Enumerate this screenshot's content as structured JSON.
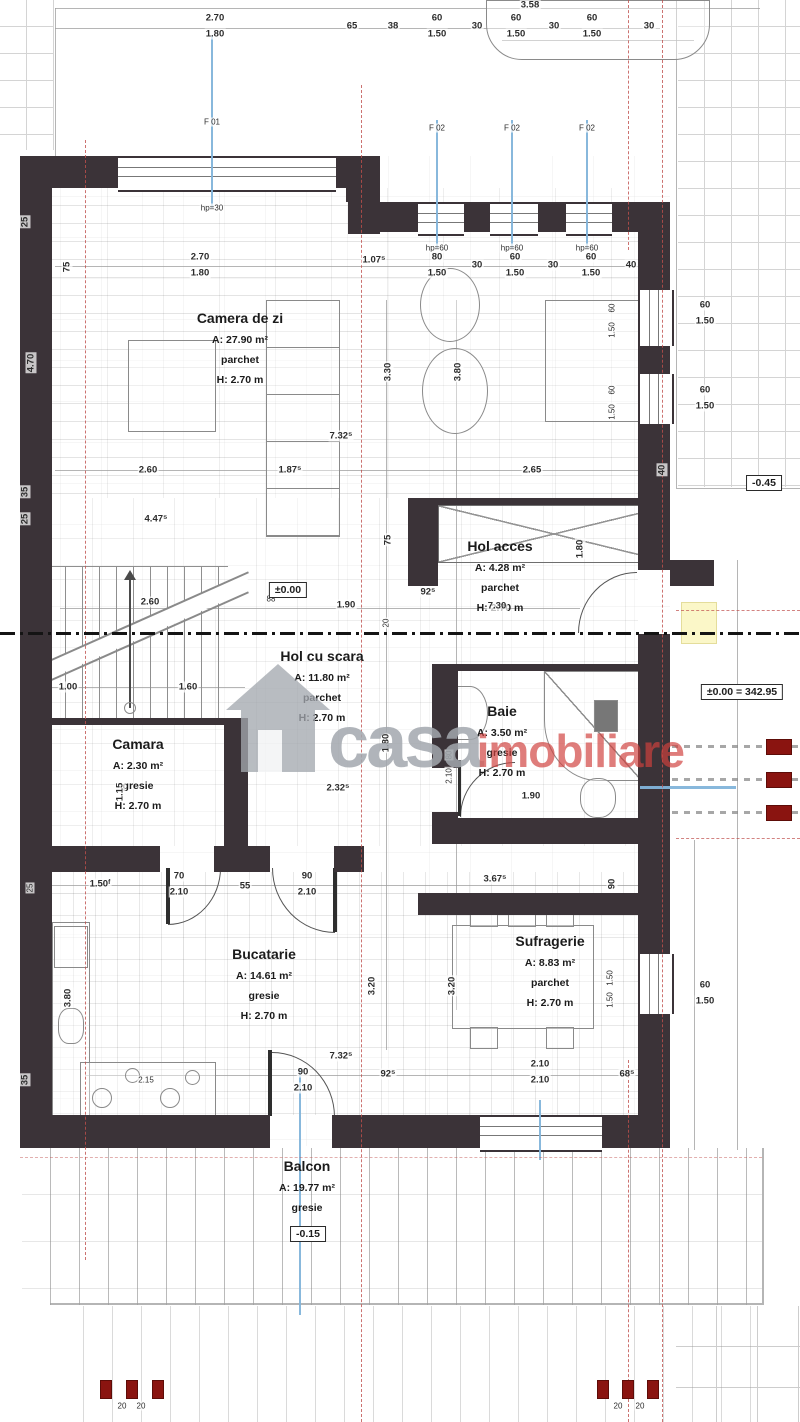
{
  "watermark": {
    "gray": "casa",
    "red": "imobiliare"
  },
  "rooms": [
    {
      "name": "Camera de zi",
      "area": "A: 27.90 m²",
      "floor": "parchet",
      "height": "H: 2.70 m"
    },
    {
      "name": "Hol acces",
      "area": "A: 4.28 m²",
      "floor": "parchet",
      "height": "H: 2.70 m"
    },
    {
      "name": "Hol cu scara",
      "area": "A: 11.80 m²",
      "floor": "parchet",
      "height": "H: 2.70 m"
    },
    {
      "name": "Camara",
      "area": "A: 2.30 m²",
      "floor": "gresie",
      "height": "H: 2.70 m"
    },
    {
      "name": "Baie",
      "area": "A: 3.50 m²",
      "floor": "gresie",
      "height": "H: 2.70 m"
    },
    {
      "name": "Bucatarie",
      "area": "A: 14.61 m²",
      "floor": "gresie",
      "height": "H: 2.70 m"
    },
    {
      "name": "Sufragerie",
      "area": "A: 8.83 m²",
      "floor": "parchet",
      "height": "H: 2.70 m"
    },
    {
      "name": "Balcon",
      "area": "A: 19.77 m²",
      "floor": "gresie"
    }
  ],
  "levels": [
    {
      "text": "±0.00",
      "x": 288,
      "y": 590
    },
    {
      "text": "-0.45",
      "x": 764,
      "y": 483
    },
    {
      "text": "±0.00 = 342.95",
      "x": 742,
      "y": 692
    },
    {
      "text": "-0.15",
      "x": 308,
      "y": 1234
    }
  ],
  "dims": [
    {
      "t": "2.70",
      "x": 215,
      "y": 18
    },
    {
      "t": "1.80",
      "x": 215,
      "y": 34
    },
    {
      "t": "65",
      "x": 352,
      "y": 26
    },
    {
      "t": "38",
      "x": 393,
      "y": 26
    },
    {
      "t": "3.58",
      "x": 530,
      "y": 5
    },
    {
      "t": "60",
      "x": 437,
      "y": 18
    },
    {
      "t": "1.50",
      "x": 437,
      "y": 34
    },
    {
      "t": "30",
      "x": 477,
      "y": 26
    },
    {
      "t": "60",
      "x": 516,
      "y": 18
    },
    {
      "t": "1.50",
      "x": 516,
      "y": 34
    },
    {
      "t": "30",
      "x": 554,
      "y": 26
    },
    {
      "t": "60",
      "x": 592,
      "y": 18
    },
    {
      "t": "1.50",
      "x": 592,
      "y": 34
    },
    {
      "t": "30",
      "x": 649,
      "y": 26
    },
    {
      "t": "F 01",
      "x": 212,
      "y": 122,
      "s": 1
    },
    {
      "t": "hp=30",
      "x": 212,
      "y": 208,
      "s": 1
    },
    {
      "t": "F 02",
      "x": 437,
      "y": 128,
      "s": 1
    },
    {
      "t": "F 02",
      "x": 512,
      "y": 128,
      "s": 1
    },
    {
      "t": "F 02",
      "x": 587,
      "y": 128,
      "s": 1
    },
    {
      "t": "hp=60",
      "x": 437,
      "y": 248,
      "s": 1
    },
    {
      "t": "hp=60",
      "x": 512,
      "y": 248,
      "s": 1
    },
    {
      "t": "hp=60",
      "x": 587,
      "y": 248,
      "s": 1
    },
    {
      "t": "75",
      "x": 67,
      "y": 267,
      "r": 1
    },
    {
      "t": "2.70",
      "x": 200,
      "y": 257
    },
    {
      "t": "1.80",
      "x": 200,
      "y": 273
    },
    {
      "t": "1.07⁵",
      "x": 374,
      "y": 260
    },
    {
      "t": "80",
      "x": 437,
      "y": 257
    },
    {
      "t": "1.50",
      "x": 437,
      "y": 273
    },
    {
      "t": "30",
      "x": 477,
      "y": 265
    },
    {
      "t": "60",
      "x": 515,
      "y": 257
    },
    {
      "t": "1.50",
      "x": 515,
      "y": 273
    },
    {
      "t": "30",
      "x": 553,
      "y": 265
    },
    {
      "t": "60",
      "x": 591,
      "y": 257
    },
    {
      "t": "1.50",
      "x": 591,
      "y": 273
    },
    {
      "t": "40",
      "x": 631,
      "y": 265
    },
    {
      "t": "25",
      "x": 25,
      "y": 222,
      "r": 1
    },
    {
      "t": "4.70",
      "x": 31,
      "y": 363,
      "r": 1
    },
    {
      "t": "35",
      "x": 25,
      "y": 492,
      "r": 1
    },
    {
      "t": "25",
      "x": 25,
      "y": 519,
      "r": 1
    },
    {
      "t": "3.30",
      "x": 388,
      "y": 372,
      "r": 1
    },
    {
      "t": "3.80",
      "x": 458,
      "y": 372,
      "r": 1
    },
    {
      "t": "60",
      "x": 612,
      "y": 308,
      "r": 1,
      "s": 1
    },
    {
      "t": "1.50",
      "x": 612,
      "y": 330,
      "r": 1,
      "s": 1
    },
    {
      "t": "60",
      "x": 612,
      "y": 390,
      "r": 1,
      "s": 1
    },
    {
      "t": "1.50",
      "x": 612,
      "y": 412,
      "r": 1,
      "s": 1
    },
    {
      "t": "60",
      "x": 705,
      "y": 305
    },
    {
      "t": "1.50",
      "x": 705,
      "y": 321
    },
    {
      "t": "60",
      "x": 705,
      "y": 390
    },
    {
      "t": "1.50",
      "x": 705,
      "y": 406
    },
    {
      "t": "7.32⁵",
      "x": 341,
      "y": 436
    },
    {
      "t": "2.60",
      "x": 148,
      "y": 470
    },
    {
      "t": "1.87⁵",
      "x": 290,
      "y": 470
    },
    {
      "t": "2.65",
      "x": 532,
      "y": 470
    },
    {
      "t": "40",
      "x": 662,
      "y": 470,
      "r": 1
    },
    {
      "t": "4.47⁵",
      "x": 156,
      "y": 519
    },
    {
      "t": "75",
      "x": 388,
      "y": 540,
      "r": 1
    },
    {
      "t": "1.80",
      "x": 580,
      "y": 549,
      "r": 1
    },
    {
      "t": "2.60",
      "x": 150,
      "y": 602
    },
    {
      "t": "88",
      "x": 271,
      "y": 599,
      "s": 1
    },
    {
      "t": "1.90",
      "x": 346,
      "y": 605
    },
    {
      "t": "92⁵",
      "x": 428,
      "y": 592
    },
    {
      "t": "7.30",
      "x": 497,
      "y": 606
    },
    {
      "t": "20",
      "x": 386,
      "y": 623,
      "r": 1,
      "s": 1
    },
    {
      "t": "1.00",
      "x": 68,
      "y": 687
    },
    {
      "t": "1.60",
      "x": 188,
      "y": 687
    },
    {
      "t": "1.80",
      "x": 386,
      "y": 743,
      "r": 1
    },
    {
      "t": "2.32⁵",
      "x": 338,
      "y": 788
    },
    {
      "t": "80",
      "x": 449,
      "y": 755,
      "r": 1,
      "s": 1
    },
    {
      "t": "2.10",
      "x": 449,
      "y": 776,
      "r": 1,
      "s": 1
    },
    {
      "t": "1.90",
      "x": 531,
      "y": 796
    },
    {
      "t": "1.15",
      "x": 120,
      "y": 792,
      "r": 1
    },
    {
      "t": "25",
      "x": 30,
      "y": 888,
      "r": 1,
      "s": 1
    },
    {
      "t": "1.50ᶠ",
      "x": 100,
      "y": 884
    },
    {
      "t": "70",
      "x": 179,
      "y": 876
    },
    {
      "t": "2.10",
      "x": 179,
      "y": 892
    },
    {
      "t": "55",
      "x": 245,
      "y": 886
    },
    {
      "t": "90",
      "x": 307,
      "y": 876
    },
    {
      "t": "2.10",
      "x": 307,
      "y": 892
    },
    {
      "t": "3.67⁵",
      "x": 495,
      "y": 879
    },
    {
      "t": "90",
      "x": 612,
      "y": 884,
      "r": 1
    },
    {
      "t": "3.20",
      "x": 372,
      "y": 986,
      "r": 1
    },
    {
      "t": "3.20",
      "x": 452,
      "y": 986,
      "r": 1
    },
    {
      "t": "3.80",
      "x": 68,
      "y": 998,
      "r": 1
    },
    {
      "t": "1.50",
      "x": 610,
      "y": 978,
      "r": 1,
      "s": 1
    },
    {
      "t": "1.50",
      "x": 610,
      "y": 1000,
      "r": 1,
      "s": 1
    },
    {
      "t": "60",
      "x": 705,
      "y": 985
    },
    {
      "t": "1.50",
      "x": 705,
      "y": 1001
    },
    {
      "t": "7.32⁵",
      "x": 341,
      "y": 1056
    },
    {
      "t": "2.15",
      "x": 146,
      "y": 1080,
      "s": 1
    },
    {
      "t": "90",
      "x": 303,
      "y": 1072
    },
    {
      "t": "2.10",
      "x": 303,
      "y": 1088
    },
    {
      "t": "92⁵",
      "x": 388,
      "y": 1074
    },
    {
      "t": "2.10",
      "x": 540,
      "y": 1064
    },
    {
      "t": "2.10",
      "x": 540,
      "y": 1080
    },
    {
      "t": "68⁵",
      "x": 627,
      "y": 1074
    },
    {
      "t": "35",
      "x": 25,
      "y": 1080,
      "r": 1
    },
    {
      "t": "20",
      "x": 122,
      "y": 1406,
      "s": 1
    },
    {
      "t": "20",
      "x": 141,
      "y": 1406,
      "s": 1
    },
    {
      "t": "20",
      "x": 618,
      "y": 1406,
      "s": 1
    },
    {
      "t": "20",
      "x": 640,
      "y": 1406,
      "s": 1
    }
  ]
}
